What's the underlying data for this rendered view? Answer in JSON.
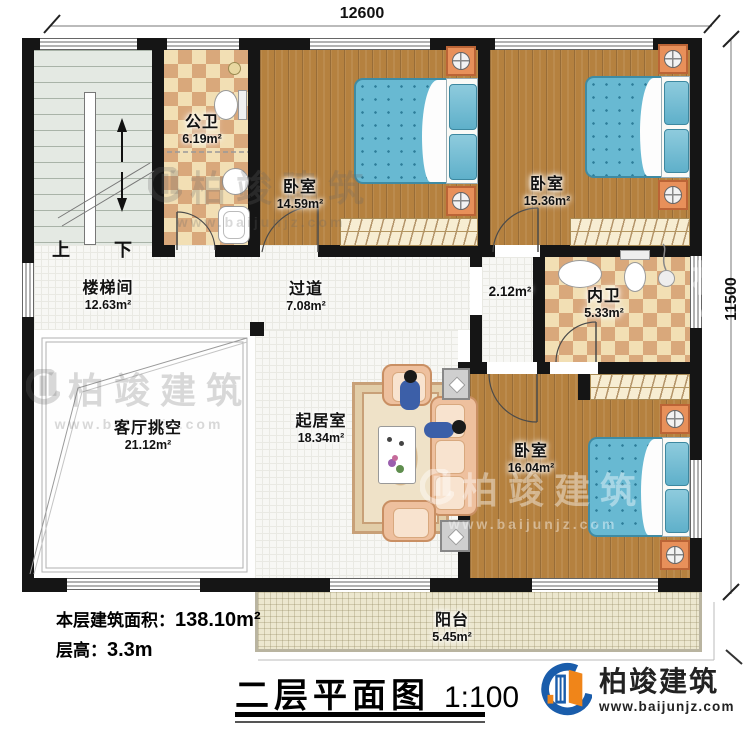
{
  "plan": {
    "dim_top": "12600",
    "dim_right": "11500",
    "stairs_up": "上",
    "stairs_down": "下"
  },
  "rooms": [
    {
      "name": "楼梯间",
      "area": "12.63m²"
    },
    {
      "name": "公卫",
      "area": "6.19m²"
    },
    {
      "name": "卧室",
      "area": "14.59m²"
    },
    {
      "name": "卧室",
      "area": "15.36m²"
    },
    {
      "name": "过道",
      "area": "7.08m²"
    },
    {
      "name": "",
      "area": "2.12m²"
    },
    {
      "name": "内卫",
      "area": "5.33m²"
    },
    {
      "name": "起居室",
      "area": "18.34m²"
    },
    {
      "name": "客厅挑空",
      "area": "21.12m²"
    },
    {
      "name": "卧室",
      "area": "16.04m²"
    },
    {
      "name": "阳台",
      "area": "5.45m²"
    }
  ],
  "info": {
    "floor_area_label": "本层建筑面积：",
    "floor_area_value": "138.10m²",
    "floor_height_label": "层高：",
    "floor_height_value": "3.3m"
  },
  "title": {
    "text": "二层平面图",
    "scale": "1:100"
  },
  "brand": {
    "name": "柏竣建筑",
    "url": "www.baijunjz.com"
  },
  "watermark": {
    "name": "柏竣建筑",
    "url": "www.baijunjz.com"
  },
  "colors": {
    "brand_blue": "#1a5dab",
    "brand_orange": "#f08519",
    "bed_blue": "#68b9d2",
    "wood": "#b5813f"
  }
}
